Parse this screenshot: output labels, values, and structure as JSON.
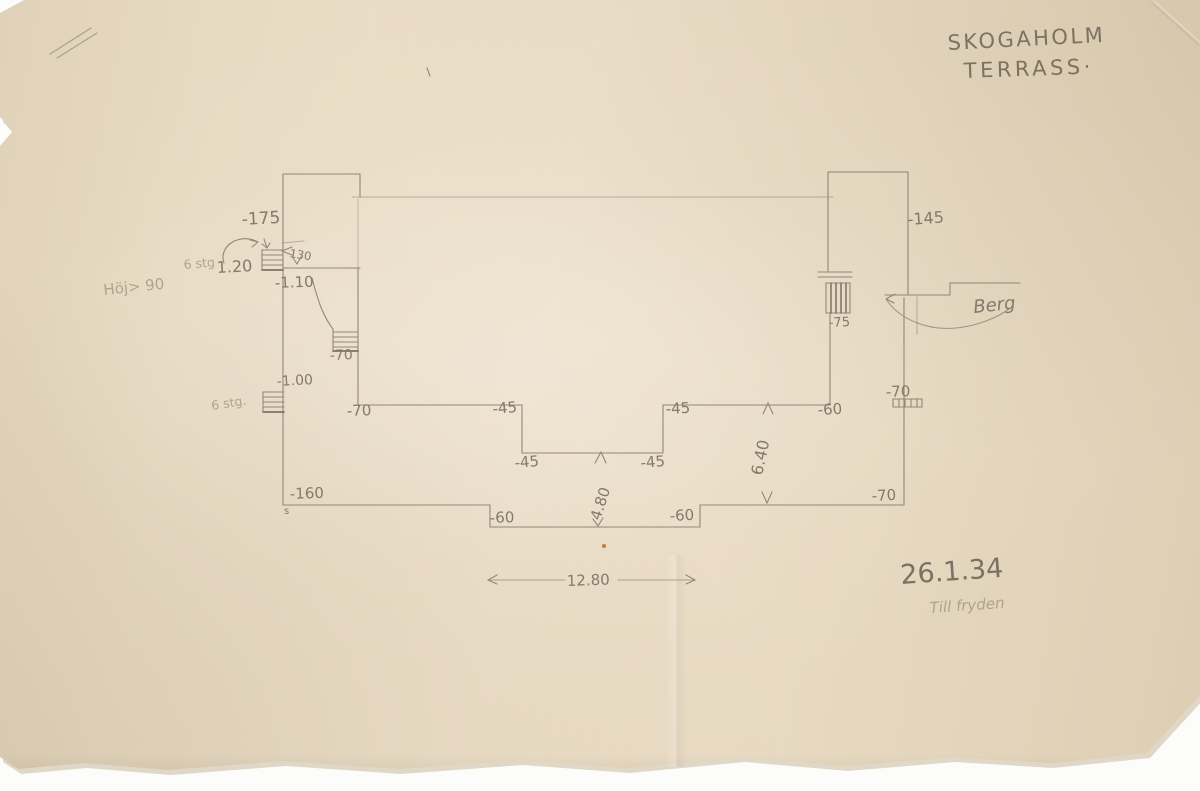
{
  "title": {
    "line1": "SKOGAHOLM",
    "line2": "TERRASS·"
  },
  "notes": {
    "date": "26.1.34",
    "below_date": "Till fryden",
    "left_margin": "Höj> 90",
    "stair_top_steps": "6 stg",
    "stair_left_steps": "6 stg.",
    "rock": "Berg",
    "stray_mark": "s"
  },
  "levels": {
    "top_left": "-175",
    "top_right": "-145",
    "upper_left_terrace": "-1.10",
    "curved_stair": "-70",
    "left_landing": "-1.00",
    "mid_left": "-70",
    "notch_upper_left": "-45",
    "notch_upper_right": "-45",
    "notch_lower_left": "-45",
    "notch_lower_right": "-45",
    "right_terrace": "-60",
    "right_wall_upper": "-70",
    "right_stair": "-75",
    "right_wall_lower": "-70",
    "bottom_left": "-160",
    "bottom_step_left": "-60",
    "bottom_step_right": "-60"
  },
  "dimensions": {
    "stair_rise": "1.20",
    "stair_width": "130",
    "depth_right": "6.40",
    "depth_center": "4.80",
    "total_width": "12.80"
  },
  "colors": {
    "paper": "#e8dbc4",
    "pencil": "#877e6f",
    "pencil_faint": "#a59a86",
    "speck_orange": "#c2702b"
  }
}
